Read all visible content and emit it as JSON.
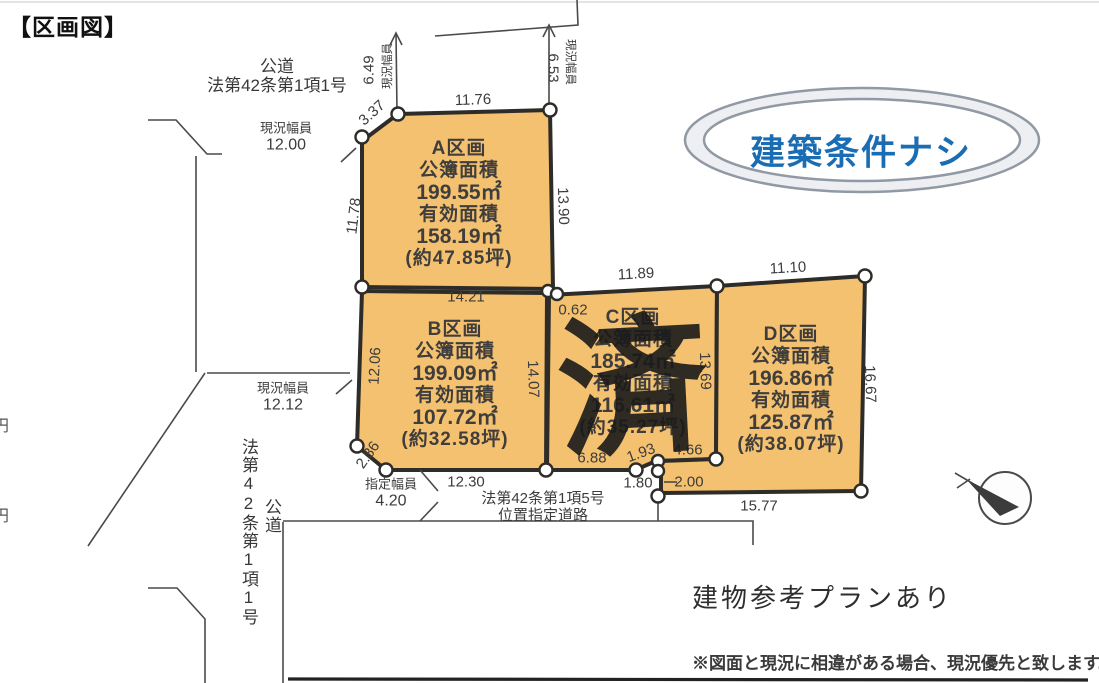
{
  "title": "【区画図】",
  "colors": {
    "parcel_fill": "#f4c170",
    "parcel_outline": "#2e2c28",
    "badge_blue": "#1a6cb3",
    "line": "#4a4a4a"
  },
  "top_road": {
    "name": "公道",
    "law": "法第42条第1項1号"
  },
  "left_road": {
    "width_label": "現況幅員",
    "width": "12.00"
  },
  "lower_left_road": {
    "width_label": "現況幅員",
    "width": "12.12"
  },
  "vertical_road": {
    "law": "法第42条第1項1号",
    "name": "公道"
  },
  "bottom_road": {
    "width_label": "指定幅員",
    "width": "4.20",
    "law": "法第42条第1項5号",
    "type": "位置指定道路"
  },
  "margin_fragments": {
    "upper": "円",
    "lower": "円"
  },
  "dims": {
    "a_top": "11.76",
    "a_bevel": "3.37",
    "a_left": "11.78",
    "a_right": "13.90",
    "top_width_left_label": "現況幅員",
    "top_width_left": "6.49",
    "top_width_right_label": "現況幅員",
    "top_width_right": "6.53",
    "b_top": "14.21",
    "ac_gap": "0.62",
    "c_top": "11.89",
    "d_top": "11.10",
    "b_left": "12.06",
    "bc_shared": "14.07",
    "cd_shared": "13.69",
    "d_right": "16.67",
    "b_bevel": "2.86",
    "b_bottom": "12.30",
    "c_bottom": "6.88",
    "c_step_diag": "1.93",
    "c_step_top": "4.66",
    "notch_width": "1.80",
    "notch_height": "2.00",
    "d_bottom": "15.77"
  },
  "parcels": [
    {
      "name": "A区画",
      "area_registered_label": "公簿面積",
      "area_registered": "199.55㎡",
      "area_effective_label": "有効面積",
      "area_effective": "158.19㎡",
      "area_tsubo": "(約47.85坪)"
    },
    {
      "name": "B区画",
      "area_registered_label": "公簿面積",
      "area_registered": "199.09㎡",
      "area_effective_label": "有効面積",
      "area_effective": "107.72㎡",
      "area_tsubo": "(約32.58坪)"
    },
    {
      "name": "C区画",
      "area_registered_label": "公簿面積",
      "area_registered": "185.74㎡",
      "area_effective_label": "有効面積",
      "area_effective": "116.61㎡",
      "area_tsubo": "(約35.27坪)"
    },
    {
      "name": "D区画",
      "area_registered_label": "公簿面積",
      "area_registered": "196.86㎡",
      "area_effective_label": "有効面積",
      "area_effective": "125.87㎡",
      "area_tsubo": "(約38.07坪)"
    }
  ],
  "stamp": "済",
  "badge": {
    "text": "建築条件ナシ"
  },
  "notes": {
    "plan": "建物参考プランあり",
    "disclaimer": "※図面と現況に相違がある場合、現況優先と致します。"
  }
}
